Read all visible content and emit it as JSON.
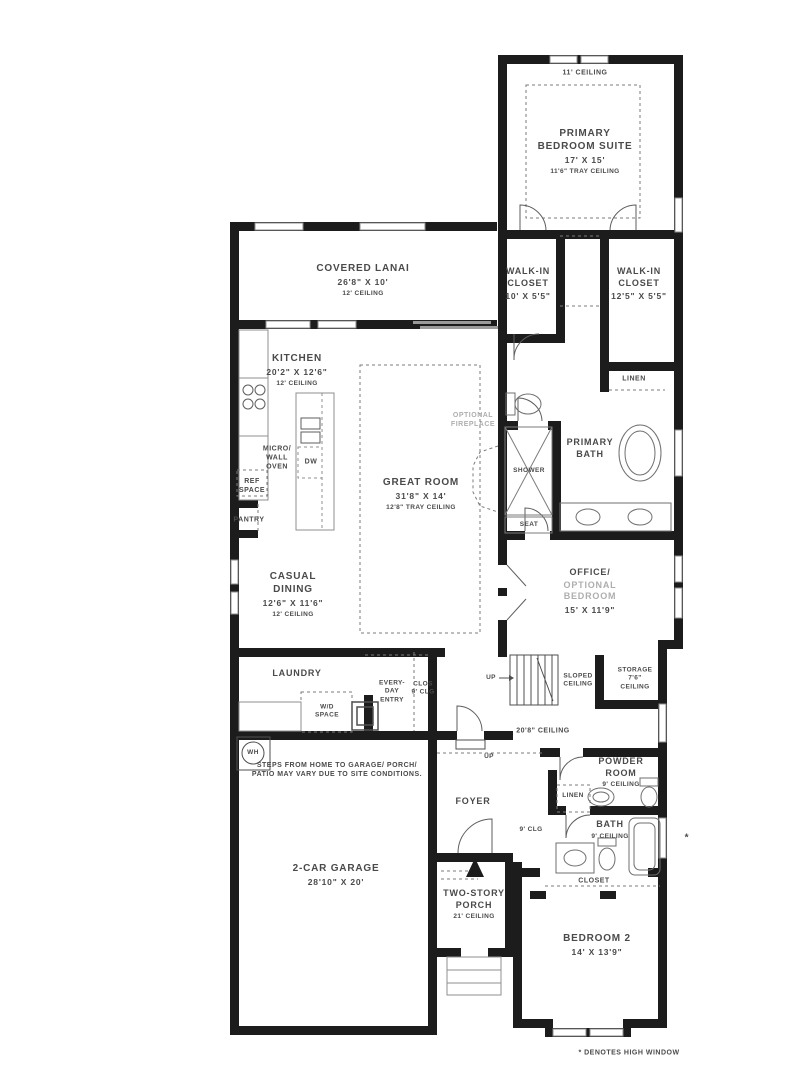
{
  "plan_type": "floor-plan",
  "colors": {
    "wall": "#1c1c1c",
    "text": "#4a4a4a",
    "muted_text": "#aeaeae",
    "fixture_line": "#6f6f6f",
    "background": "#ffffff"
  },
  "rooms": {
    "primary_suite": {
      "ceiling_label": "11' CEILING",
      "title": "PRIMARY\nBEDROOM SUITE",
      "dims": "17' X 15'",
      "ceiling": "11'6\" TRAY CEILING"
    },
    "walk_in_closet_1": {
      "title": "WALK-IN\nCLOSET",
      "dims": "10' X 5'5\""
    },
    "walk_in_closet_2": {
      "title": "WALK-IN\nCLOSET",
      "dims": "12'5\" X 5'5\""
    },
    "linen_1": {
      "title": "LINEN"
    },
    "covered_lanai": {
      "title": "COVERED LANAI",
      "dims": "26'8\" X 10'",
      "ceiling": "12' CEILING"
    },
    "kitchen": {
      "title": "KITCHEN",
      "dims": "20'2\" X 12'6\"",
      "ceiling": "12' CEILING"
    },
    "micro_wall_oven": {
      "title": "MICRO/\nWALL\nOVEN"
    },
    "ref_space": {
      "title": "REF\nSPACE"
    },
    "pantry": {
      "title": "PANTRY"
    },
    "dishwasher": {
      "title": "DW"
    },
    "great_room": {
      "title": "GREAT ROOM",
      "dims": "31'8\" X 14'",
      "ceiling": "12'8\" TRAY CEILING"
    },
    "optional_fireplace": {
      "title": "OPTIONAL\nFIREPLACE"
    },
    "shower": {
      "title": "SHOWER"
    },
    "seat": {
      "title": "SEAT"
    },
    "primary_bath": {
      "title": "PRIMARY\nBATH"
    },
    "office": {
      "title": "OFFICE/",
      "subtitle": "OPTIONAL\nBEDROOM",
      "dims": "15' X 11'9\""
    },
    "casual_dining": {
      "title": "CASUAL\nDINING",
      "dims": "12'6\" X 11'6\"",
      "ceiling": "12' CEILING"
    },
    "laundry": {
      "title": "LAUNDRY"
    },
    "wd_space": {
      "title": "W/D\nSPACE"
    },
    "everyday_entry": {
      "title": "EVERY-\nDAY\nENTRY"
    },
    "entry_closet": {
      "title": "CLOS\n9' CLG"
    },
    "stairs_up": {
      "title": "UP"
    },
    "sloped_ceiling": {
      "title": "SLOPED\nCEILING"
    },
    "storage": {
      "title": "STORAGE\n7'6\"\nCEILING"
    },
    "hall_ceiling": {
      "title": "20'8\" CEILING"
    },
    "garage_up": {
      "title": "UP"
    },
    "water_heater": {
      "title": "WH"
    },
    "garage_note": {
      "title": "STEPS FROM HOME TO GARAGE/ PORCH/\nPATIO MAY VARY DUE TO SITE CONDITIONS."
    },
    "garage": {
      "title": "2-CAR GARAGE",
      "dims": "28'10\" X 20'"
    },
    "foyer": {
      "title": "FOYER"
    },
    "hall_9clg": {
      "title": "9' CLG"
    },
    "powder_room": {
      "title": "POWDER\nROOM",
      "ceiling": "9' CEILING"
    },
    "linen_2": {
      "title": "LINEN"
    },
    "bath_2": {
      "title": "BATH",
      "ceiling": "9' CEILING"
    },
    "closet_bedroom2": {
      "title": "CLOSET"
    },
    "two_story_porch": {
      "title": "TWO-STORY\nPORCH",
      "ceiling": "21' CEILING"
    },
    "bedroom_2": {
      "title": "BEDROOM 2",
      "dims": "14' X 13'9\""
    }
  },
  "notes": {
    "high_window_marker": "*",
    "footnote": "* DENOTES HIGH WINDOW"
  }
}
